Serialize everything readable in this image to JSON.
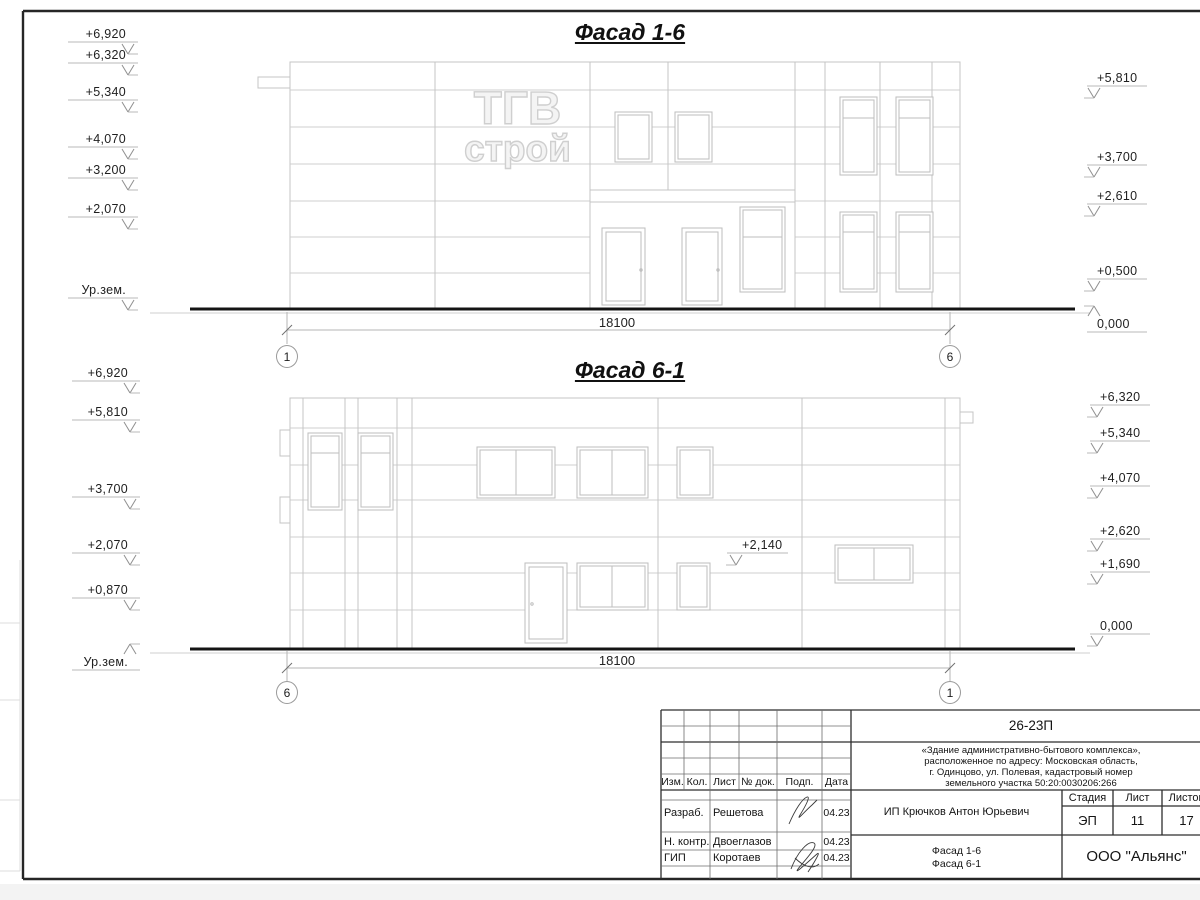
{
  "sheet": {
    "facade1": {
      "title": "Фасад 1-6",
      "dimension": "18100",
      "axis_left": "1",
      "axis_right": "6",
      "left_marks": [
        "+6,920",
        "+6,320",
        "+5,340",
        "+4,070",
        "+3,200",
        "+2,070",
        "Ур.зем."
      ],
      "right_marks": [
        "+5,810",
        "+3,700",
        "+2,610",
        "+0,500",
        "0,000"
      ],
      "logo": {
        "line1": "ТГВ",
        "line2": "строй"
      }
    },
    "facade2": {
      "title": "Фасад 6-1",
      "dimension": "18100",
      "axis_left": "6",
      "axis_right": "1",
      "left_marks": [
        "+6,920",
        "+5,810",
        "+3,700",
        "+2,070",
        "+0,870",
        "Ур.зем."
      ],
      "right_marks": [
        "+6,320",
        "+5,340",
        "+4,070",
        "+2,620",
        "+1,690",
        "0,000"
      ],
      "mid_mark": "+2,140"
    }
  },
  "titleblock": {
    "doc_number": "26-23П",
    "description_lines": [
      "«Здание административно-бытового комплекса»,",
      "расположенное по адресу: Московская область,",
      "г. Одинцово, ул. Полевая, кадастровый номер",
      "земельного участка 50:20:0030206:266"
    ],
    "header_columns": [
      "Изм.",
      "Кол.",
      "Лист",
      "№ док.",
      "Подп.",
      "Дата"
    ],
    "staff": [
      {
        "role": "Разраб.",
        "name": "Решетова",
        "date": "04.23"
      },
      {
        "role": "Н. контр.",
        "name": "Двоеглазов",
        "date": "04.23"
      },
      {
        "role": "ГИП",
        "name": "Коротаев",
        "date": "04.23"
      }
    ],
    "client": "ИП Крючков Антон Юрьевич",
    "stage_label": "Стадия",
    "sheet_label": "Лист",
    "sheets_label": "Листов",
    "stage": "ЭП",
    "sheet_number": "11",
    "sheets_total": "17",
    "subject_lines": [
      "Фасад 1-6",
      "Фасад 6-1"
    ],
    "organization": "ООО \"Альянс\""
  }
}
